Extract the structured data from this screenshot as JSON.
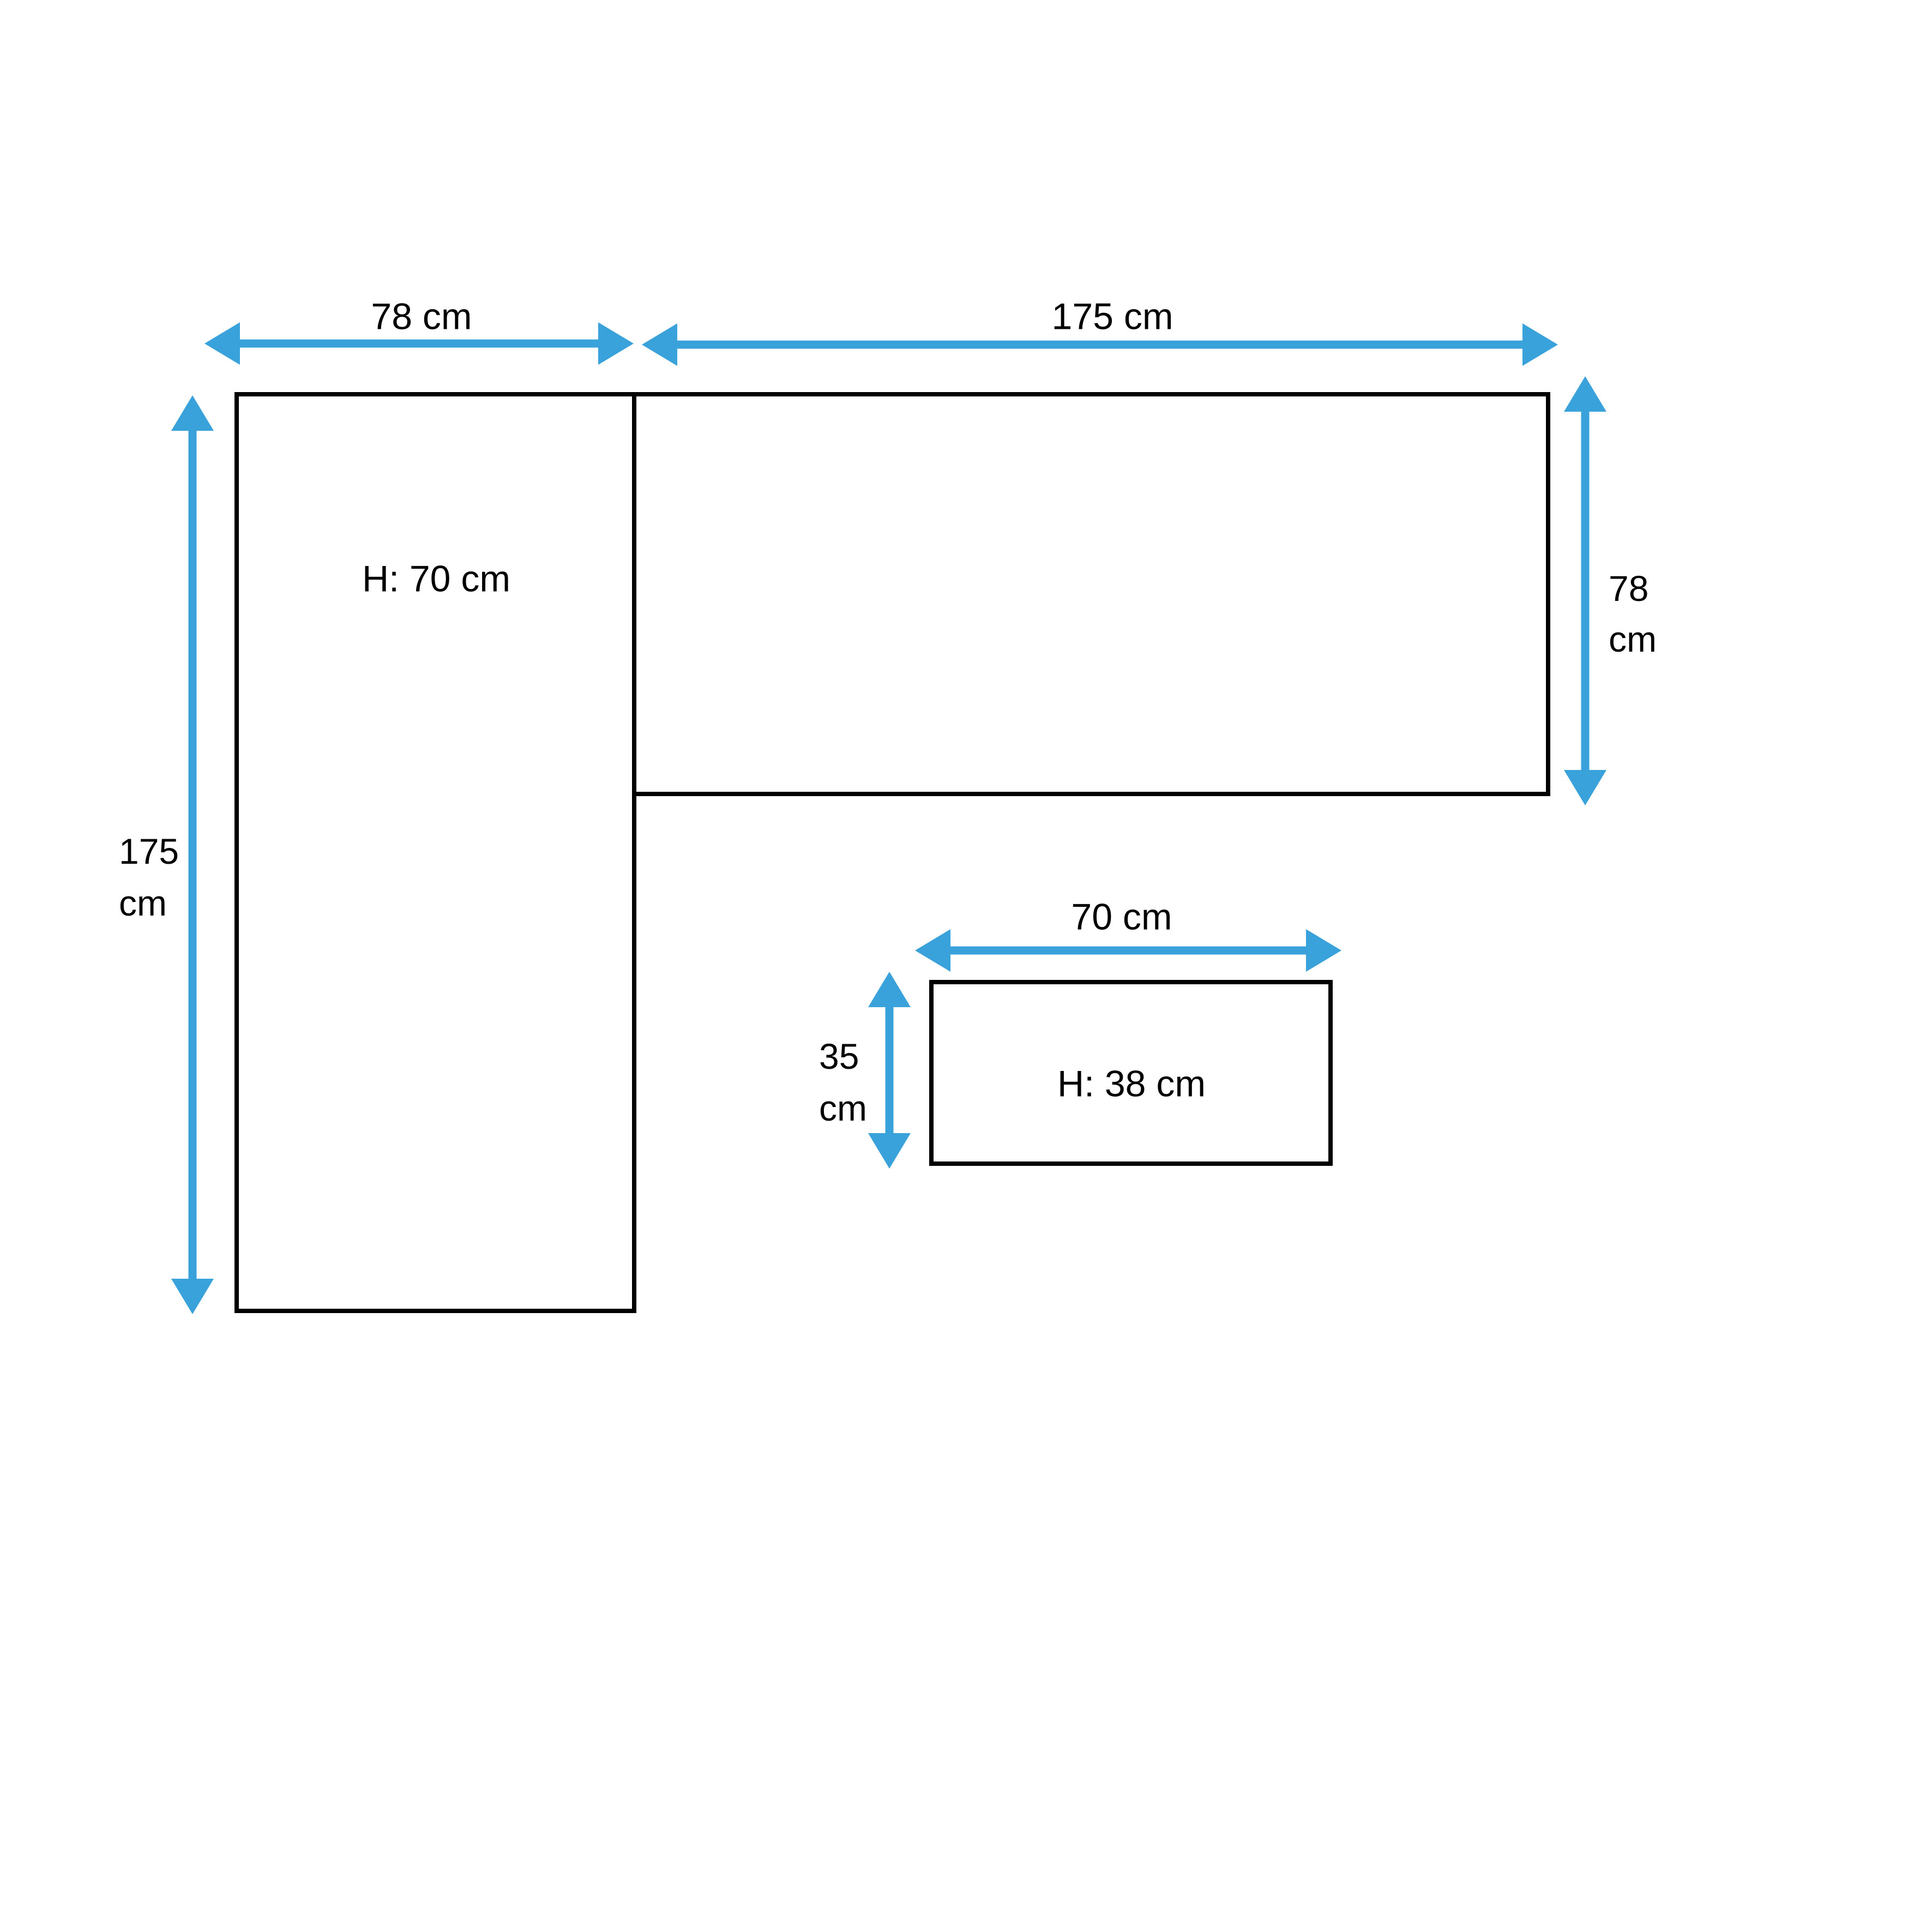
{
  "colors": {
    "arrow": "#3AA2DA",
    "outline": "#000000",
    "text": "#000000",
    "background": "#FFFFFF"
  },
  "diagram": {
    "type": "furniture-dimension-diagram",
    "pieces": {
      "desk_side_panel": {
        "height_label": "H: 70 cm"
      },
      "desk_top_panel": {},
      "small_table_panel": {
        "height_label": "H: 38 cm"
      }
    },
    "dimensions": {
      "desk_side_width": {
        "label": "78 cm"
      },
      "desk_top_length": {
        "label": "175 cm"
      },
      "desk_side_length": {
        "line1": "175",
        "line2": "cm"
      },
      "desk_top_depth": {
        "line1": "78",
        "line2": "cm"
      },
      "small_table_width": {
        "label": "70 cm"
      },
      "small_table_depth": {
        "line1": "35",
        "line2": "cm"
      }
    }
  }
}
